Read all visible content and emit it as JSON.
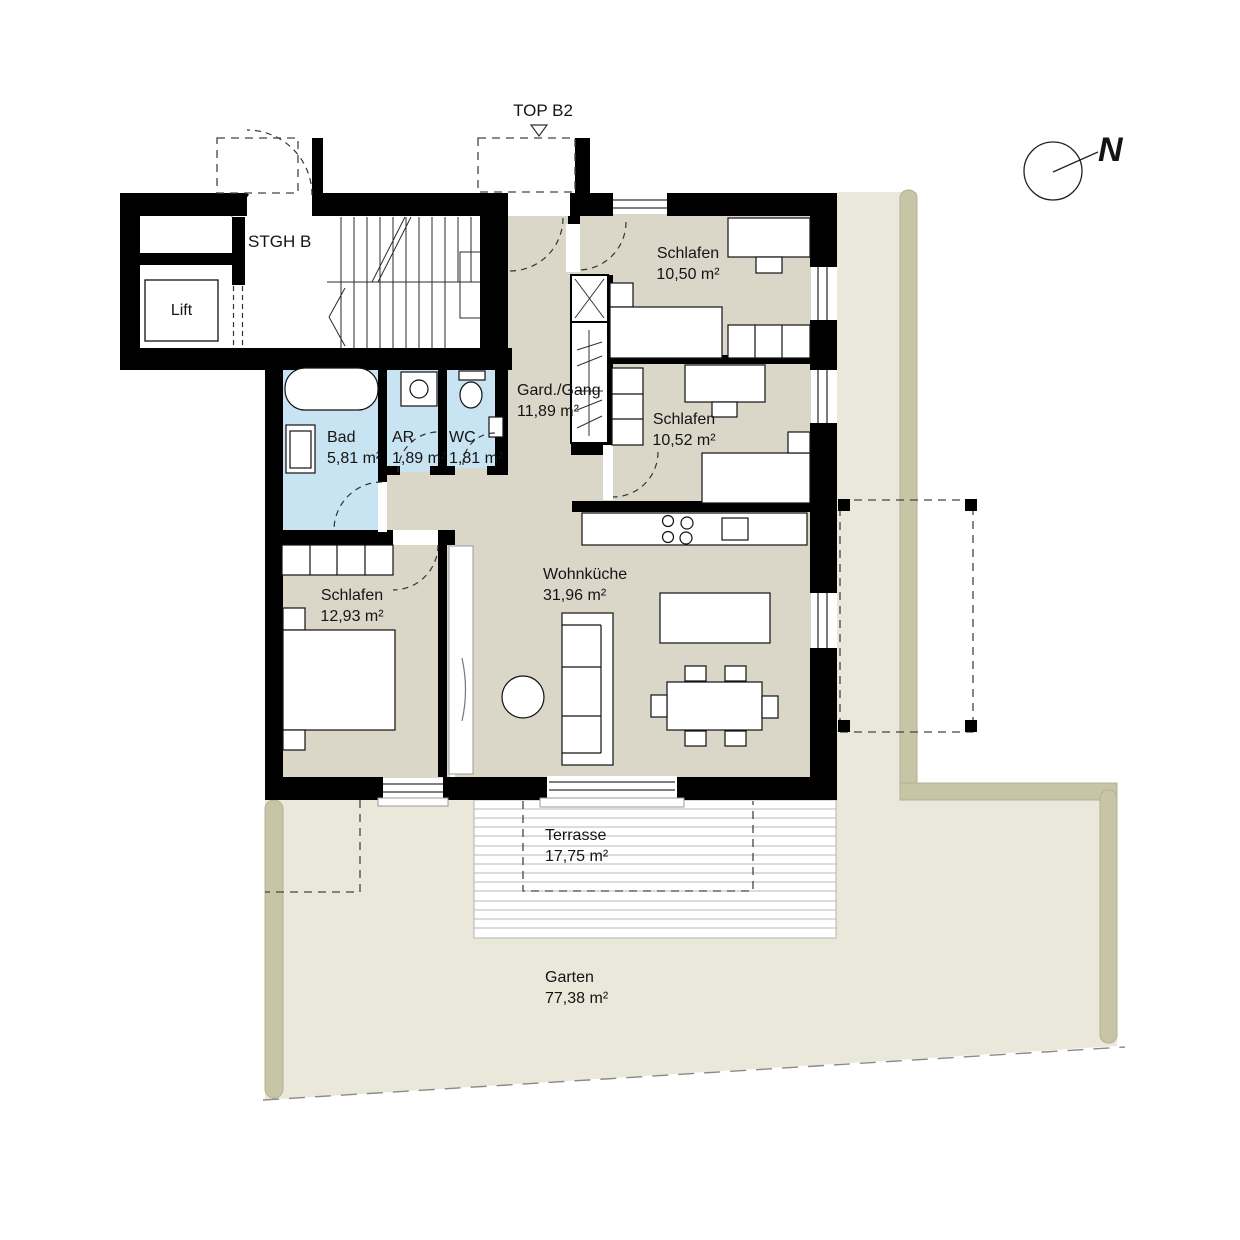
{
  "plan": {
    "title_unit": "TOP B2",
    "compass_label": "N",
    "stairwell_label": "STGH B",
    "lift_label": "Lift"
  },
  "rooms": {
    "schlafen_1": {
      "name": "Schlafen",
      "area": "10,50 m²"
    },
    "schlafen_2": {
      "name": "Schlafen",
      "area": "10,52 m²"
    },
    "garderobe_gang": {
      "name": "Gard./Gang",
      "area": "11,89 m²"
    },
    "bad": {
      "name": "Bad",
      "area": "5,81 m²"
    },
    "abstellraum": {
      "name": "AR",
      "area": "1,89 m²"
    },
    "wc": {
      "name": "WC",
      "area": "1,81 m²"
    },
    "schlafen_3": {
      "name": "Schlafen",
      "area": "12,93 m²"
    },
    "wohnkueche": {
      "name": "Wohnküche",
      "area": "31,96 m²"
    },
    "terrasse": {
      "name": "Terrasse",
      "area": "17,75 m²"
    },
    "garten": {
      "name": "Garten",
      "area": "77,38 m²"
    }
  },
  "colors": {
    "wall": "#000000",
    "room_fill": "#dbd7c8",
    "wet_room_fill": "#c8e3f2",
    "garden_fill": "#e9e8db",
    "hedge_fill": "#c7c5a6",
    "terrace_fill": "#ffffff"
  }
}
